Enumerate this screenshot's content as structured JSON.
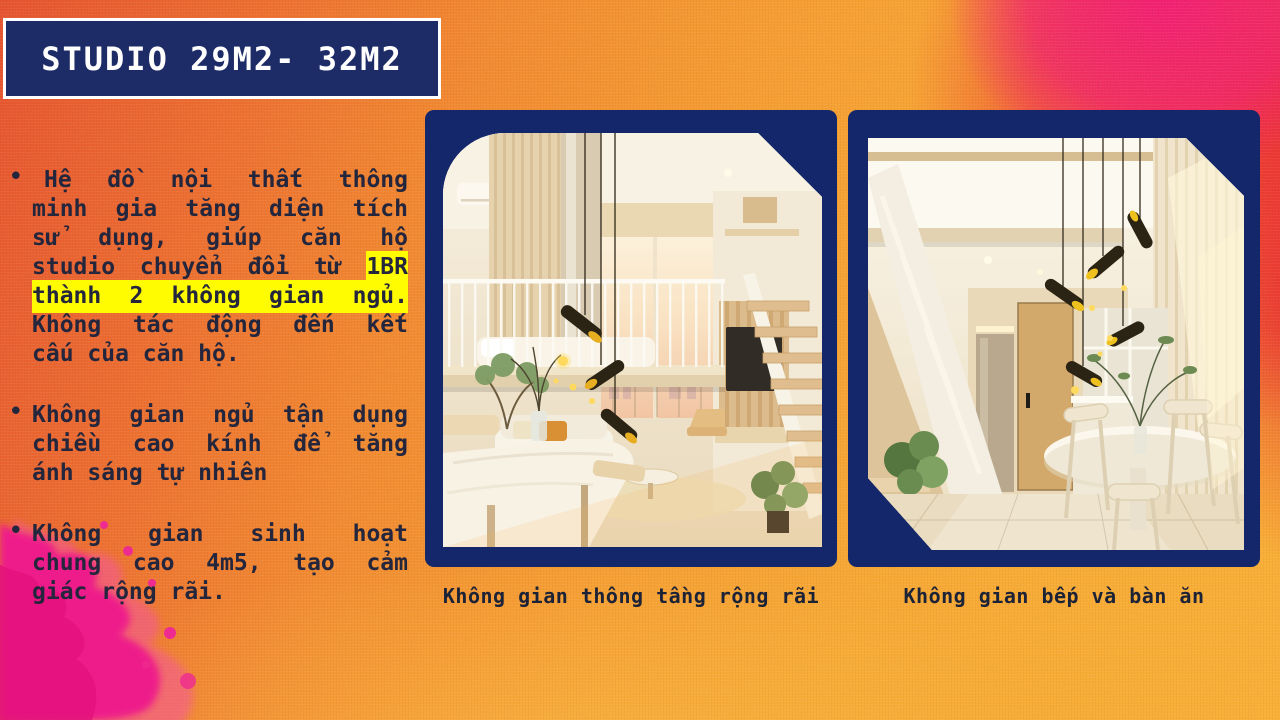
{
  "title": "STUDIO 29M2- 32M2",
  "bullet_glyph": "•",
  "bullets": [
    {
      "text": "Hệ đồ nội thất thông minh gia tăng diện tích sử dụng, giúp căn hộ studio chuyển đổi từ 1BR thành 2 không gian ngủ. Không tác động đến kết cấu của căn hộ.",
      "highlighted_phrase": "1BR thành 2 không gian ngủ.",
      "lines": [
        {
          "pre": "Hệ đồ nội thất thông",
          "indent": true
        },
        {
          "pre": "minh gia tăng diện tích"
        },
        {
          "pre": "sử dụng, giúp căn hộ"
        },
        {
          "pre": "studio chuyển đổi từ ",
          "hl": "1BR"
        },
        {
          "hl": "thành 2 không gian ngủ."
        },
        {
          "pre": "Không tác động đến kết"
        },
        {
          "pre": "cấu của căn hộ.",
          "last": true
        }
      ]
    },
    {
      "text": "Không gian ngủ tận dụng chiều cao kính để tăng ánh sáng tự nhiên",
      "lines": [
        {
          "pre": "Không gian ngủ tận dụng"
        },
        {
          "pre": "chiều cao kính để tăng"
        },
        {
          "pre": "ánh sáng tự nhiên",
          "last": true
        }
      ]
    },
    {
      "text": "Không gian sinh hoạt chung cao 4m5, tạo cảm giác rộng rãi.",
      "lines": [
        {
          "pre": "Không gian sinh hoạt"
        },
        {
          "pre": "chung cao 4m5, tạo cảm"
        },
        {
          "pre": "giác rộng rãi.",
          "last": true
        }
      ]
    }
  ],
  "figures": [
    {
      "caption": "Không gian thông tầng rộng rãi"
    },
    {
      "caption": "Không gian bếp và bàn ăn"
    }
  ],
  "colors": {
    "navy_title": "#1d2b66",
    "navy_frame": "#13276a",
    "ink": "#23263c",
    "cap": "#1d2337",
    "hl": "#fffb00",
    "bg_red_topleft": "#e3431d",
    "bg_orange_mid": "#f4941f",
    "bg_yellow_bottom": "#f8a824",
    "bg_crimson": "#e91620",
    "bg_magenta": "#f00a67",
    "splash_pink": "#ee1b8a",
    "white": "#ffffff"
  }
}
